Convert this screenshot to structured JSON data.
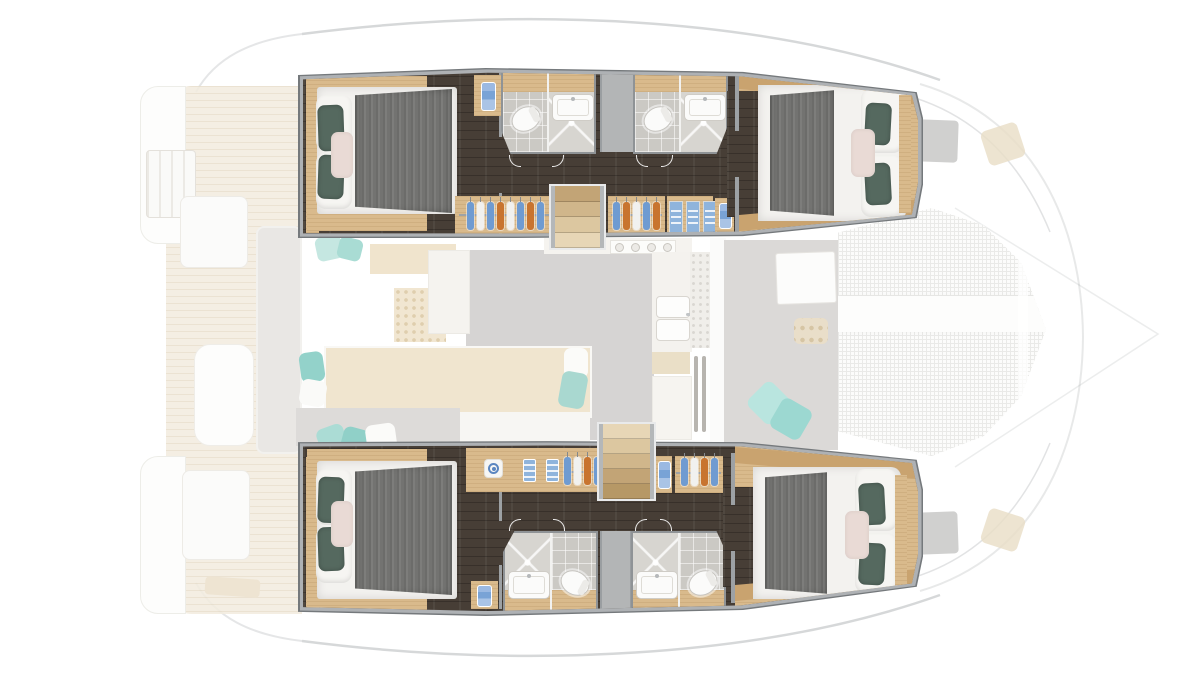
{
  "scene": {
    "title": "Catamaran four-cabin accommodation layout, deck plan top view",
    "type": "yacht-floor-plan-rendering",
    "orientation": "bow-right",
    "highlighted": "hull cabins and bathrooms (full color)",
    "faded": "saloon, galley, cockpits, side decks and bow trampoline (washed out)"
  },
  "palette": {
    "background": "#ffffff",
    "hull_outline": "#75797c",
    "hull_wall": "#aeb1b4",
    "floor_dark": "#473e36",
    "wood": "#d9ba8c",
    "wood_dark": "#c9a36f",
    "wood_pale": "#e7d4ae",
    "tile": "#cbc9c4",
    "tile_light": "#d7d5d0",
    "fixture": "#fbfbfa",
    "blanket_a": "#6c6c6a",
    "blanket_b": "#7d7d7b",
    "pillow_teal": "#55695f",
    "pillow_blush": "#e9dad5",
    "towel_blue": "#79a3d6",
    "deck_teak": "#f3ecdf",
    "deck_line": "#e8decb",
    "saloon_floor": "#d6d4d3",
    "aqua": "#a9dcd4",
    "mesh": "#eaeae8",
    "gray_band": "#b3b5b6"
  },
  "port_hull": {
    "label": "Port hull (top)",
    "aft_cabin": {
      "label": "Aft double cabin",
      "berth": "island double berth",
      "pillows": [
        "white",
        "white",
        "teal",
        "teal",
        "blush"
      ],
      "blanket": "gray throw"
    },
    "forward_cabin": {
      "label": "Forward double cabin",
      "berth": "island double berth",
      "pillows": [
        "white",
        "white",
        "teal",
        "teal",
        "blush"
      ],
      "blanket": "gray throw"
    },
    "bathroom_aft": {
      "label": "Aft head",
      "fixtures": [
        "toilet",
        "washbasin",
        "shower"
      ]
    },
    "bathroom_fwd": {
      "label": "Forward head",
      "fixtures": [
        "toilet",
        "washbasin",
        "shower"
      ]
    },
    "wardrobe_aft": {
      "hangers": [
        "#6f9bd1",
        "#f1f1ef",
        "#6f9bd1",
        "#c8742f",
        "#f1f1ef",
        "#6f9bd1",
        "#c8742f",
        "#6f9bd1"
      ]
    },
    "wardrobe_fwd": {
      "hangers": [
        "#6f9bd1",
        "#c8742f",
        "#f1f1ef",
        "#6f9bd1",
        "#c8742f"
      ],
      "shelf_stacks": [
        "#8fb4dc",
        "#8fb4dc",
        "#8fb4dc"
      ]
    },
    "companionway": {
      "treads": [
        "#c2a476",
        "#d0b68b",
        "#dcc7a0",
        "#e7d6b6"
      ]
    },
    "towel_niches": 3,
    "mast_compartment": true
  },
  "starboard_hull": {
    "label": "Starboard hull (bottom)",
    "aft_cabin": {
      "label": "Aft double cabin",
      "berth": "island double berth",
      "pillows": [
        "white",
        "white",
        "teal",
        "teal",
        "blush"
      ],
      "blanket": "gray throw"
    },
    "forward_cabin": {
      "label": "Forward double cabin",
      "berth": "island double berth",
      "pillows": [
        "white",
        "white",
        "teal",
        "teal",
        "blush"
      ],
      "blanket": "gray throw"
    },
    "bathroom_aft": {
      "label": "Aft head",
      "fixtures": [
        "shower",
        "washbasin",
        "toilet"
      ]
    },
    "bathroom_fwd": {
      "label": "Forward head",
      "fixtures": [
        "shower",
        "washbasin",
        "toilet"
      ]
    },
    "wardrobe_aft": {
      "hangers": [
        "#6f9bd1",
        "#f1f1ef",
        "#c8742f",
        "#6f9bd1"
      ],
      "shelf_stacks": [
        "#8fb4dc",
        "#8fb4dc"
      ],
      "logo_plate": true
    },
    "wardrobe_fwd": {
      "hangers": [
        "#6f9bd1",
        "#f1f1ef",
        "#c8742f",
        "#6f9bd1"
      ]
    },
    "companionway": {
      "treads": [
        "#e7d6b6",
        "#dcc7a0",
        "#d0b68b",
        "#c2a476",
        "#b69866"
      ]
    },
    "towel_niches": 3
  },
  "main_deck": {
    "saloon": {
      "label": "Saloon and galley (faded)",
      "features": [
        "daybed with cushions",
        "galley counter",
        "double sink",
        "4-burner stove",
        "control panel",
        "ventilation louvers",
        "perforated grille panel"
      ],
      "stove_burners": [
        "#eceae6",
        "#eceae6",
        "#eceae6",
        "#eceae6"
      ],
      "cushions": [
        "#c5e7e1",
        "#a9dcd4",
        "#93d2ca",
        "#fbfbf9"
      ]
    },
    "forward_cockpit": {
      "label": "Forward cockpit (faded)",
      "features": [
        "deck hatch",
        "cup tray",
        "aqua scatter cushions"
      ]
    },
    "aft_cockpit": {
      "label": "Aft cockpit (faded)",
      "features": [
        "sofa",
        "table",
        "stern lockers",
        "swim ladder",
        "teak deck"
      ]
    },
    "foredeck": {
      "label": "Foredeck (faded)",
      "features": [
        "trampoline net",
        "anchor bridle band",
        "deck hatches"
      ],
      "hatches": 2
    }
  }
}
